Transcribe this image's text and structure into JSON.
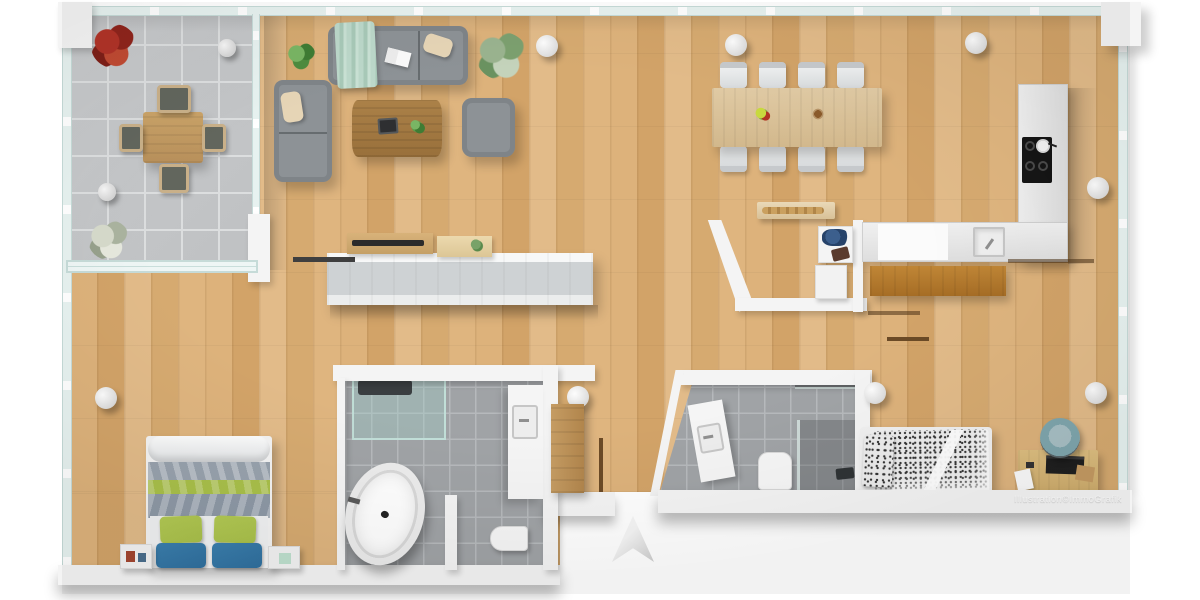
{
  "image": {
    "type": "3d-floor-plan",
    "style": "top-down architectural rendering of an apartment",
    "background": "#ffffff"
  },
  "watermark": {
    "text": "Illustration©ImmoGrafik"
  },
  "palette": {
    "wood_floor": "#ddb27b",
    "terrace_tile": "#c8cacc",
    "tile_grout": "#dcdedf",
    "bath_tile": "#a0a3a6",
    "bath_grout": "#b6b9bc",
    "wall_white": "#f4f4f4",
    "glass": "#e7f2f0",
    "glass_frame": "#c6dbd8",
    "sofa_gray": "#8d9296",
    "throw_mint": "#bcd8ca",
    "cushion_beige": "#e6d5b6",
    "dining_wood": "#e0caa4",
    "bench_wood": "#c08636",
    "cooktop_black": "#151515",
    "bed1_green": "#a9c04a",
    "bed1_blue": "#2f6f9d",
    "bed1_gray": "#98a2ad",
    "bed2_pattern": "#343434",
    "chair_teal": "#7fa6ad",
    "plant_red": "#a52f26",
    "plant_green": "#5d9b49",
    "plant_sage": "#9fb39a",
    "shadow": "rgba(0,0,0,0.22)"
  },
  "rooms": [
    {
      "id": "terrace",
      "label": "Tiled terrace",
      "furniture": [
        "square wood table",
        "4 chairs",
        "red plant",
        "pale plant",
        "2 round stools"
      ]
    },
    {
      "id": "living-area",
      "label": "Open living area",
      "furniture": [
        "3-seat gray sofa with mint throw",
        "2-seat gray sofa",
        "wood coffee table",
        "gray armchair",
        "potted plants",
        "long white lowboard"
      ]
    },
    {
      "id": "dining-area",
      "label": "Dining area",
      "furniture": [
        "wooden table for 8",
        "8 white chairs",
        "fruit bowl",
        "wood sideboard shelf"
      ]
    },
    {
      "id": "kitchen",
      "label": "Kitchen",
      "furniture": [
        "L-shaped white counter",
        "4-zone cooktop with frying pan",
        "sink",
        "wooden bench"
      ]
    },
    {
      "id": "pantry-laundry",
      "label": "Pantry / laundry nook",
      "furniture": [
        "washing machine with laundry",
        "dryer"
      ]
    },
    {
      "id": "bedroom-1",
      "label": "Bedroom with double bed",
      "furniture": [
        "double bed with green and blue pillows",
        "2 nightstands"
      ]
    },
    {
      "id": "bathroom-1",
      "label": "Main bathroom",
      "furniture": [
        "glass shower",
        "freestanding oval bathtub",
        "vanity with sink",
        "toilet",
        "wood wardrobe"
      ]
    },
    {
      "id": "bathroom-2",
      "label": "Second bathroom",
      "furniture": [
        "angled vanity with sink",
        "toilet",
        "dark-tiled shower"
      ]
    },
    {
      "id": "bedroom-2",
      "label": "Bedroom with single bed",
      "furniture": [
        "single bed with patterned duvet",
        "wood desk with laptop",
        "teal office chair",
        "papers"
      ]
    }
  ],
  "structure": {
    "columns": 8,
    "glazing": "floor-to-ceiling glass along top and left facades",
    "compass": "north arrow at bottom center"
  }
}
